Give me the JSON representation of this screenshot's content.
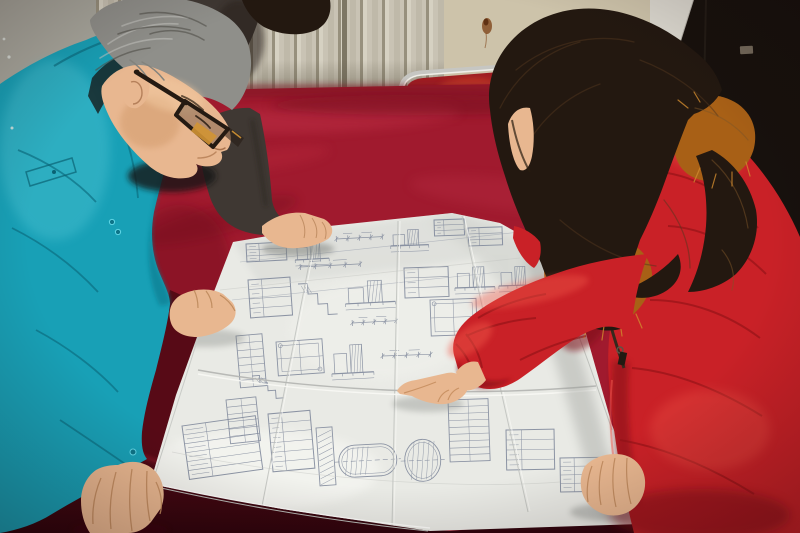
{
  "meta": {
    "title": "Two workers reviewing a large folded technical drawing spread on a red velvet-covered table"
  },
  "scene": {
    "setting": "Indoor room with a beige finned radiator along the wall and a dark doorway at right",
    "people": [
      {
        "id": "engineer-left",
        "description": "Middle-aged man with gray hair and dark-framed glasses wearing a teal work jacket, leaning over the table with both hands on the drawing"
      },
      {
        "id": "colleague-behind",
        "description": "Partially visible person in a dark jacket standing behind, right hand resting on the top edge of the drawing"
      },
      {
        "id": "woman-right",
        "description": "Woman with long dark wavy hair wearing a red parka with orange fur-trimmed hood, pointing at the drawing with her right index finger"
      }
    ],
    "objects": [
      {
        "id": "blueprint",
        "description": "Large white folded engineering drawing sheet with dense line-work, tables and fold creases"
      },
      {
        "id": "table",
        "description": "Table draped in crimson velvet cloth with darker front edge"
      },
      {
        "id": "chair",
        "description": "Chrome tube-framed chair with red seat behind the table"
      },
      {
        "id": "radiator",
        "description": "Beige wall radiator with vertical fins"
      },
      {
        "id": "doorway",
        "description": "Dark open doorway with small metal latch"
      }
    ]
  },
  "colors": {
    "wall_left": "#a8a79d",
    "radiator_base": "#c9c3b4",
    "wall_right": "#cdc3aa",
    "wall_stripe": "#dbd8cf",
    "door_dark": "#17110d",
    "chrome": "#c6c6c2",
    "chair_seat": "#9e1d22",
    "velvet_bright": "#a01a2e",
    "velvet_dark": "#4a0713",
    "paper": "#e9eae5",
    "line_art": "#7b8498",
    "jacket_teal": "#18a0b6",
    "jacket_dark": "#3f3833",
    "coat_red": "#c92127",
    "hair_black": "#231810",
    "hair_gray": "#8f8f8a",
    "fur_orange": "#a86016",
    "skin": "#e8b790"
  },
  "blueprint": {
    "clusters": [
      {
        "t": "rows",
        "x": 246,
        "y": 244,
        "w": 40,
        "h": 18,
        "r": -3
      },
      {
        "t": "elev",
        "x": 294,
        "y": 238,
        "w": 34,
        "h": 22,
        "r": -3
      },
      {
        "t": "dim",
        "x": 336,
        "y": 232,
        "w": 46,
        "h": 14,
        "r": -3
      },
      {
        "t": "elev",
        "x": 390,
        "y": 226,
        "w": 38,
        "h": 20,
        "r": -2
      },
      {
        "t": "rows",
        "x": 434,
        "y": 220,
        "w": 30,
        "h": 16,
        "r": -2
      },
      {
        "t": "rows",
        "x": 468,
        "y": 228,
        "w": 34,
        "h": 18,
        "r": -2
      },
      {
        "t": "rows",
        "x": 248,
        "y": 280,
        "w": 42,
        "h": 38,
        "r": -4
      },
      {
        "t": "steps",
        "x": 298,
        "y": 284,
        "w": 38,
        "h": 32,
        "r": -3
      },
      {
        "t": "elev",
        "x": 344,
        "y": 276,
        "w": 50,
        "h": 28,
        "r": -3
      },
      {
        "t": "rows",
        "x": 404,
        "y": 268,
        "w": 44,
        "h": 30,
        "r": -2
      },
      {
        "t": "elev",
        "x": 454,
        "y": 262,
        "w": 40,
        "h": 26,
        "r": -2
      },
      {
        "t": "elev",
        "x": 498,
        "y": 262,
        "w": 36,
        "h": 24,
        "r": -2
      },
      {
        "t": "dim",
        "x": 300,
        "y": 262,
        "w": 60,
        "h": 10,
        "r": -3
      },
      {
        "t": "dim",
        "x": 352,
        "y": 318,
        "w": 44,
        "h": 10,
        "r": -3
      },
      {
        "t": "ladder",
        "x": 236,
        "y": 336,
        "w": 26,
        "h": 52,
        "r": -5
      },
      {
        "t": "plan",
        "x": 276,
        "y": 342,
        "w": 46,
        "h": 34,
        "r": -4
      },
      {
        "t": "elev",
        "x": 330,
        "y": 338,
        "w": 42,
        "h": 36,
        "r": -3
      },
      {
        "t": "dim",
        "x": 382,
        "y": 342,
        "w": 48,
        "h": 28,
        "r": -2
      },
      {
        "t": "plan",
        "x": 430,
        "y": 300,
        "w": 46,
        "h": 36,
        "r": -2
      },
      {
        "t": "elev",
        "x": 476,
        "y": 340,
        "w": 40,
        "h": 30,
        "r": -2
      },
      {
        "t": "steps",
        "x": 252,
        "y": 376,
        "w": 30,
        "h": 24,
        "r": -4
      },
      {
        "t": "ladder",
        "x": 226,
        "y": 400,
        "w": 30,
        "h": 44,
        "r": -6
      },
      {
        "t": "rows",
        "x": 182,
        "y": 426,
        "w": 74,
        "h": 54,
        "r": -8
      },
      {
        "t": "rows",
        "x": 268,
        "y": 414,
        "w": 42,
        "h": 58,
        "r": -5
      },
      {
        "t": "hatchbar",
        "x": 316,
        "y": 428,
        "w": 16,
        "h": 58,
        "r": -4
      },
      {
        "t": "vessel",
        "x": 338,
        "y": 446,
        "w": 58,
        "h": 32,
        "r": -3
      },
      {
        "t": "vessel",
        "x": 404,
        "y": 440,
        "w": 36,
        "h": 42,
        "r": -2
      },
      {
        "t": "ladder",
        "x": 448,
        "y": 400,
        "w": 40,
        "h": 62,
        "r": -2
      },
      {
        "t": "rows",
        "x": 506,
        "y": 430,
        "w": 48,
        "h": 40,
        "r": -1
      },
      {
        "t": "rows",
        "x": 560,
        "y": 458,
        "w": 44,
        "h": 34,
        "r": -1
      }
    ]
  }
}
